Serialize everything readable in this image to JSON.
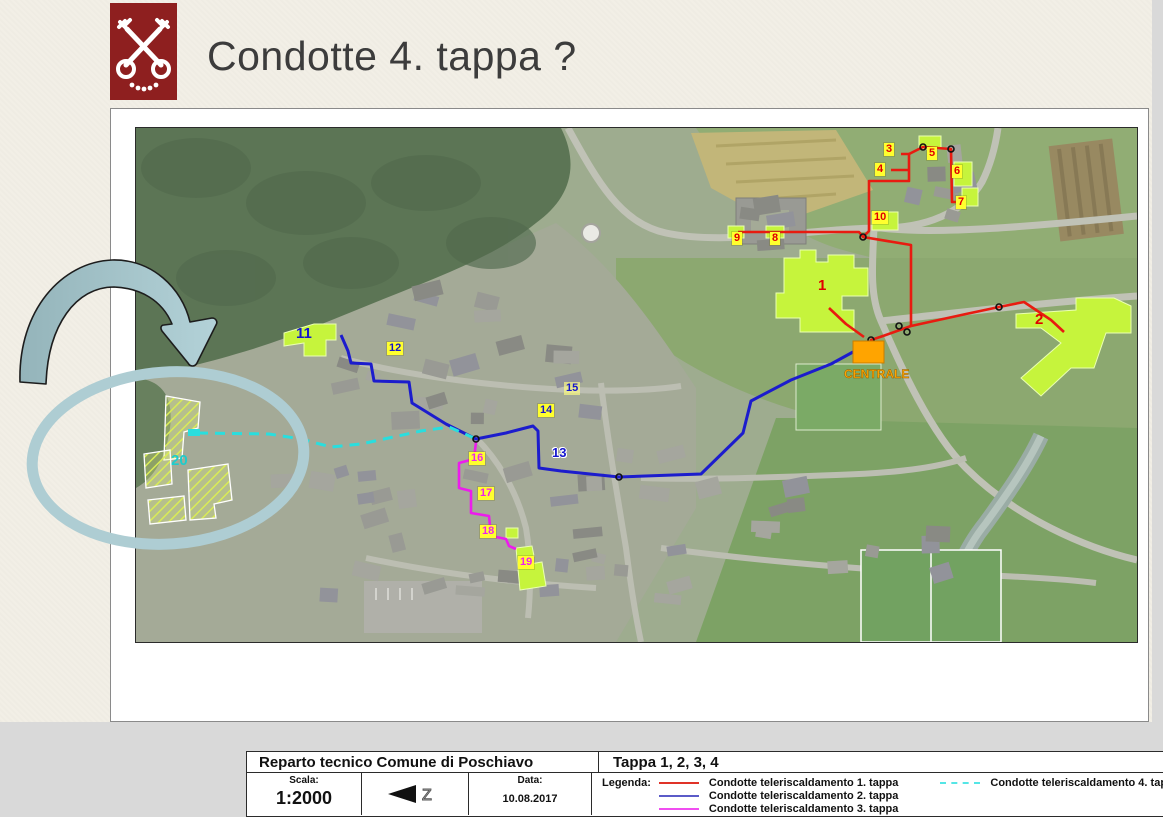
{
  "slide": {
    "title": "Condotte 4. tappa ?"
  },
  "logo": {
    "name": "poschiavo-coat-of-arms",
    "bg_color": "#8e1f1f"
  },
  "map": {
    "plan_header": {
      "left": "Reparto tecnico Comune di Poschiavo",
      "right": "Tappa 1, 2, 3, 4"
    },
    "info": {
      "scale_label": "Scala:",
      "scale_value": "1:2000",
      "north_letter": "Z",
      "date_label": "Data:",
      "date_value": "10.08.2017",
      "legend_label": "Legenda:"
    },
    "legend": [
      {
        "label": "Condotte teleriscaldamento 1. tappa",
        "color": "#e03228",
        "dash": false
      },
      {
        "label": "Condotte teleriscaldamento 2. tappa",
        "color": "#5b5bc8",
        "dash": false
      },
      {
        "label": "Condotte teleriscaldamento 3. tappa",
        "color": "#f04ef0",
        "dash": false
      },
      {
        "label": "Condotte teleriscaldamento 4. tappa",
        "color": "#55e6e6",
        "dash": true
      }
    ],
    "centrale_label": "CENTRALE",
    "markers": [
      {
        "label": "1",
        "x": 680,
        "y": 150,
        "color": "#e00000",
        "style": "plain"
      },
      {
        "label": "2",
        "x": 897,
        "y": 184,
        "color": "#e00000",
        "style": "plain"
      },
      {
        "label": "3",
        "x": 748,
        "y": 15,
        "color": "#e00000",
        "style": "box"
      },
      {
        "label": "4",
        "x": 739,
        "y": 35,
        "color": "#e00000",
        "style": "box"
      },
      {
        "label": "5",
        "x": 791,
        "y": 19,
        "color": "#e00000",
        "style": "box"
      },
      {
        "label": "6",
        "x": 816,
        "y": 37,
        "color": "#e00000",
        "style": "box"
      },
      {
        "label": "7",
        "x": 820,
        "y": 68,
        "color": "#e00000",
        "style": "box"
      },
      {
        "label": "8",
        "x": 634,
        "y": 104,
        "color": "#e00000",
        "style": "box"
      },
      {
        "label": "9",
        "x": 596,
        "y": 104,
        "color": "#e00000",
        "style": "box"
      },
      {
        "label": "10",
        "x": 736,
        "y": 83,
        "color": "#e00000",
        "style": "box"
      },
      {
        "label": "11",
        "x": 158,
        "y": 198,
        "color": "#1515cc",
        "style": "plain"
      },
      {
        "label": "12",
        "x": 251,
        "y": 214,
        "color": "#1515cc",
        "style": "box"
      },
      {
        "label": "13",
        "x": 414,
        "y": 318,
        "color": "#1515cc",
        "style": "halo"
      },
      {
        "label": "14",
        "x": 402,
        "y": 276,
        "color": "#1515cc",
        "style": "box"
      },
      {
        "label": "15",
        "x": 428,
        "y": 254,
        "color": "#1515cc",
        "style": "pale"
      },
      {
        "label": "16",
        "x": 333,
        "y": 324,
        "color": "#ee22ee",
        "style": "box"
      },
      {
        "label": "17",
        "x": 342,
        "y": 359,
        "color": "#ee22ee",
        "style": "box"
      },
      {
        "label": "18",
        "x": 344,
        "y": 397,
        "color": "#ee22ee",
        "style": "box"
      },
      {
        "label": "19",
        "x": 382,
        "y": 428,
        "color": "#ee22ee",
        "style": "box"
      },
      {
        "label": "20",
        "x": 33,
        "y": 325,
        "color": "#1ecccc",
        "style": "plain"
      }
    ],
    "routes": [
      {
        "name": "condotte-1-tappa",
        "color": "#e81b10",
        "width": 2.6,
        "dash": null,
        "polylines": [
          [
            [
              602,
              104
            ],
            [
              723,
              104
            ],
            [
              727,
              109
            ],
            [
              775,
              117
            ],
            [
              775,
              198
            ]
          ],
          [
            [
              775,
              198
            ],
            [
              747,
              208
            ],
            [
              735,
              212
            ],
            [
              735,
              224
            ]
          ],
          [
            [
              693,
              180
            ],
            [
              710,
              196
            ],
            [
              728,
              209
            ]
          ],
          [
            [
              775,
              198
            ],
            [
              830,
              186
            ],
            [
              863,
              179
            ],
            [
              888,
              174
            ],
            [
              915,
              192
            ],
            [
              928,
              204
            ]
          ],
          [
            [
              727,
              109
            ],
            [
              733,
              103
            ],
            [
              733,
              53
            ],
            [
              773,
              53
            ],
            [
              773,
              26
            ],
            [
              765,
              26
            ]
          ],
          [
            [
              773,
              26
            ],
            [
              787,
              19
            ],
            [
              815,
              21
            ],
            [
              816,
              74
            ],
            [
              823,
              74
            ]
          ],
          [
            [
              755,
              42
            ],
            [
              773,
              42
            ]
          ]
        ]
      },
      {
        "name": "condotte-2-tappa",
        "color": "#1c1ccd",
        "width": 3,
        "dash": null,
        "polylines": [
          [
            [
              205,
              207
            ],
            [
              212,
              223
            ],
            [
              215,
              235
            ],
            [
              235,
              236
            ],
            [
              238,
              253
            ],
            [
              273,
              254
            ],
            [
              276,
              275
            ],
            [
              289,
              283
            ],
            [
              310,
              296
            ],
            [
              340,
              311
            ],
            [
              370,
              305
            ],
            [
              397,
              298
            ],
            [
              402,
              303
            ],
            [
              403,
              340
            ],
            [
              425,
              343
            ],
            [
              483,
              349
            ],
            [
              565,
              346
            ],
            [
              607,
              305
            ],
            [
              615,
              273
            ],
            [
              655,
              252
            ],
            [
              695,
              236
            ],
            [
              717,
              224
            ]
          ]
        ]
      },
      {
        "name": "condotte-3-tappa",
        "color": "#ec1cec",
        "width": 2.6,
        "dash": null,
        "polylines": [
          [
            [
              340,
              314
            ],
            [
              338,
              331
            ],
            [
              323,
              335
            ],
            [
              323,
              360
            ],
            [
              335,
              363
            ],
            [
              335,
              385
            ],
            [
              353,
              388
            ],
            [
              355,
              408
            ],
            [
              370,
              411
            ],
            [
              373,
              418
            ],
            [
              380,
              421
            ]
          ]
        ]
      },
      {
        "name": "condotte-4-tappa",
        "color": "#29dede",
        "width": 3,
        "dash": "10,7",
        "polylines": [
          [
            [
              62,
              305
            ],
            [
              133,
              306
            ],
            [
              165,
              311
            ],
            [
              195,
              319
            ],
            [
              225,
              316
            ],
            [
              285,
              303
            ],
            [
              313,
              299
            ],
            [
              338,
              310
            ]
          ]
        ]
      }
    ],
    "nodes": [
      [
        727,
        109
      ],
      [
        787,
        19
      ],
      [
        815,
        21
      ],
      [
        763,
        198
      ],
      [
        771,
        204
      ],
      [
        863,
        179
      ],
      [
        735,
        212
      ],
      [
        340,
        311
      ],
      [
        483,
        349
      ]
    ]
  },
  "annotation": {
    "arrow_color": "#a9c8ce",
    "ellipse_color": "#aecdd3"
  }
}
